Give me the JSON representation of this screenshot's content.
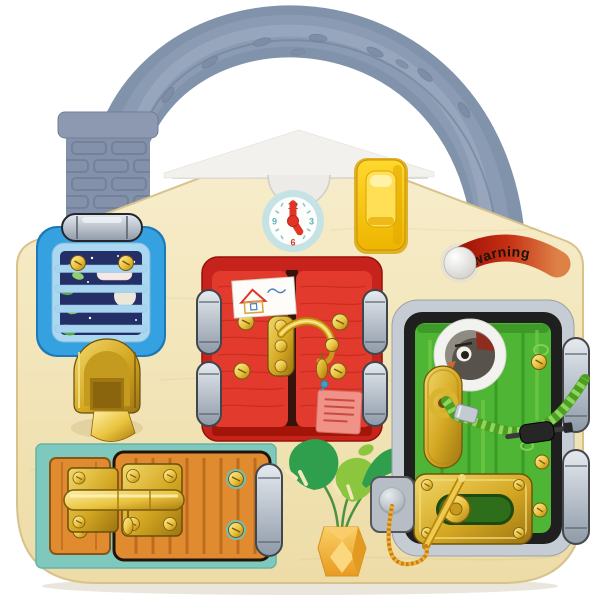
{
  "product": {
    "name": "house busy board toy",
    "warning_label": "warning"
  },
  "clock": {
    "numerals": {
      "top": "12",
      "right": "3",
      "bottom": "6",
      "left": "9"
    }
  },
  "colors": {
    "background": "#ffffff",
    "board": "#f4e6bd",
    "board_edge": "#d8c28c",
    "handle": "#8093ab",
    "chimney": "#8491aa",
    "roof_trim": "#f2f1ed",
    "clock_ring": "#c5e3e5",
    "clock_face": "#fdfdfb",
    "clock_hands": "#e23526",
    "numeral_teal": "#5fb0ba",
    "numeral_dark": "#3d4f66",
    "numeral_red": "#d8372b",
    "switch_toggle": "#ffdf55",
    "window_blue": "#35a1e0",
    "window_inner": "#abd8f1",
    "night_sky": "#232f66",
    "mint_panel": "#7fc8be",
    "orange_door": "#e08b30",
    "red_frame": "#c6231c",
    "red_door": "#e23b2e",
    "green_door": "#4fb534",
    "door_frame_black": "#1f1f1f",
    "frame_gray": "#c6ccd3",
    "rope_green": "#5fae2b",
    "string_orange": "#e39a17",
    "leaf_dark": "#2f9e4d",
    "leaf_light": "#8cc63e",
    "pot_yellow": "#f5b53a",
    "gold": "#d9ab25"
  }
}
